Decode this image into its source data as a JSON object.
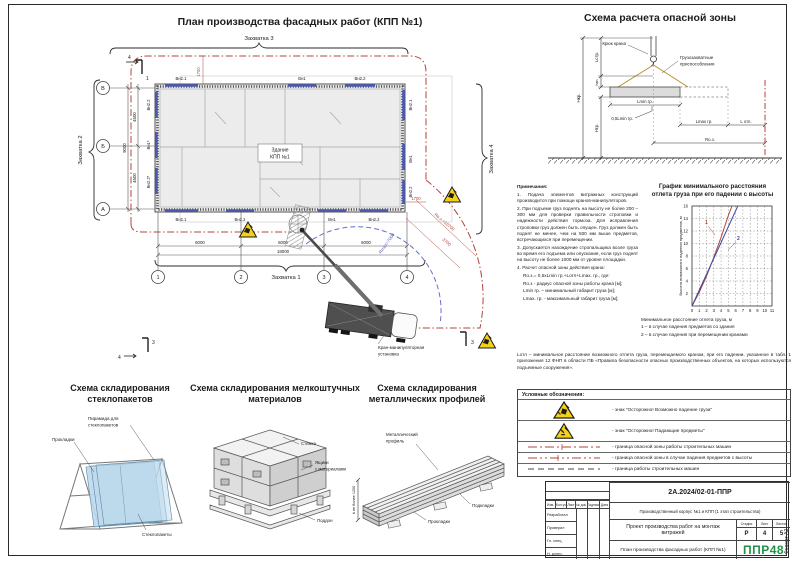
{
  "page": {
    "format_note": "Формат А2"
  },
  "plan": {
    "title": "План производства фасадных работ (КПП №1)",
    "building_line1": "Здание",
    "building_line2": "КПП №1",
    "zone1": "Захватка 1",
    "zone2": "Захватка 2",
    "zone3": "Захватка 3",
    "zone4": "Захватка 4",
    "axis_letters": [
      "В",
      "Б",
      "А"
    ],
    "axis_numbers": [
      "1",
      "2",
      "3",
      "4"
    ],
    "dim_4500a": "4500",
    "dim_4500b": "4500",
    "dim_9000": "9000",
    "dim_6000a": "6000",
    "dim_6000b": "6000",
    "dim_6000c": "6000",
    "dim_18000": "18000",
    "dim_1700_top": "1700",
    "dim_1700_right": "1700",
    "dim_3700": "3700",
    "r_danger": "Rо.з.=10700",
    "r_max": "Rmax=7000",
    "win_top": [
      "Вн2.1",
      "Вн1",
      "Вн2.2"
    ],
    "win_bottom": [
      "Вн2.1",
      "Вн2.2",
      "Вн1",
      "Вн2.2"
    ],
    "win_left": [
      "Вн2.2",
      "Вн1*",
      "Вн2.2*"
    ],
    "win_right": [
      "Вн2.1",
      "Вн1",
      "Вн2.2"
    ],
    "crane_line1": "Кран-манипуляторная",
    "crane_line2": "установка",
    "mark1": "1",
    "mark3": "3",
    "mark4": "4"
  },
  "danger_scheme": {
    "title": "Схема расчета опасной зоны",
    "hook": "Крюк крана",
    "rig1": "Грузозахватные",
    "rig2": "приспособления",
    "lmin": "Lmin гр.",
    "half_lmin": "0,5Lmin гр.",
    "lmax": "Lmax гр.",
    "lotl": "L отл.",
    "roz": "Rо.з.",
    "hkr": "Нкр.",
    "hgr": "Нгр.",
    "lstr": "Lстр.",
    "hzp": "hзп."
  },
  "graph": {
    "title1": "График минимального расстояния",
    "title2": "отлета груза при его падении с высоты",
    "ylabel": "Высота возможного падения предметов, м",
    "xlabel": "Минимальное расстояние отлета груза, м",
    "legend1": "1 – в случае падения предметов со здания",
    "legend2": "2 – в случае падения при перемещении кранами",
    "label1": "1",
    "label2": "2"
  },
  "chart_data": {
    "type": "line",
    "title": "График минимального расстояния отлета груза при его падении с высоты",
    "xlabel": "Минимальное расстояние отлета груза, м",
    "ylabel": "Высота возможного падения предметов, м",
    "xlim": [
      0,
      11
    ],
    "ylim": [
      0,
      16
    ],
    "grid": true,
    "x_ticks": [
      0,
      1,
      2,
      3,
      4,
      5,
      6,
      7,
      8,
      9,
      10,
      11
    ],
    "y_ticks": [
      2,
      4,
      6,
      8,
      10,
      12,
      14,
      16
    ],
    "series": [
      {
        "name": "1 – в случае падения предметов со здания",
        "color": "#b0443b",
        "x": [
          0,
          1,
          2,
          3,
          4,
          5,
          5.5
        ],
        "y": [
          0,
          2.2,
          4.8,
          7.8,
          11,
          14.5,
          16
        ]
      },
      {
        "name": "2 – в случае падения при перемещении кранами",
        "color": "#3a4aaa",
        "x": [
          0,
          6.3
        ],
        "y": [
          0,
          16
        ]
      }
    ]
  },
  "notes": {
    "heading": "Примечания:",
    "items": [
      "1. Подача элементов витражных конструкций производится при помощи кранов-манипуляторов.",
      "2. При подъеме груз поднять на высоту не более 200 – 300 мм для проверки правильности строповки и надежности действия тормоза. Для исправления строповки груз должен быть опущен. Груз должен быть поднят не менее, чем на 500 мм выше предметов, встречающихся при перемещении.",
      "3. Допускается нахождение стропальщика возле груза во время его подъема или опускания, если груз поднят на высоту не более 1000 мм от уровня площадки.",
      "4. Расчет опасной зоны действия крана:",
      "Rо.з.= 0,5xLmin гр.+Lотл+Lmax. гр., где:",
      "Rо.з - радиус опасной зоны работы крана [м];",
      "Lmin гр. – минимальный габарит груза [м];",
      "Lmax. гр. - максимальный габарит груза [м];"
    ]
  },
  "lotl_note": "Lотл – минимальное расстояние возможного отлета груза, перемещаемого краном, при его падении, указанное в табл. 1 приложения 12 ФНП в области ПБ «Правила безопасности опасных производственных объектов, на которых используются подъемные сооружения».",
  "legend": {
    "heading": "Условные обозначения:",
    "rows": [
      {
        "text": "- знак \"Осторожно! Возможно падение груза\""
      },
      {
        "text": "- знак \"Осторожно! Падающие предметы\""
      },
      {
        "text": "- граница опасной зоны работы строительных машин"
      },
      {
        "text": "- граница опасной зоны в случае падения предметов с высоты"
      },
      {
        "text": "- граница работы строительных машин"
      }
    ]
  },
  "storage": {
    "glass": {
      "title1": "Схема складирования",
      "title2": "стеклопакетов",
      "pyramid1": "Пирамида для",
      "pyramid2": "стеклопакетов",
      "spacers": "Прокладки",
      "panes": "Стеклопакеты"
    },
    "small": {
      "title1": "Схема складирования мелкоштучных",
      "title2": "материалов",
      "tie": "Стяжка",
      "boxes1": "Ящики",
      "boxes2": "с материалами",
      "pallet": "Поддон"
    },
    "metal": {
      "title1": "Схема складирования",
      "title2": "металлических профилей",
      "profile1": "Металлический",
      "profile2": "профиль",
      "supports": "Подкладки",
      "spacers": "Прокладки",
      "height": "h не более 1200"
    }
  },
  "titleblock": {
    "doc_number": "2А.2024/02-01-ППР",
    "object_name": "Производственный корпус №1 и КПП (1 этап строительства)",
    "project_name": "Проект производства работ на монтаж витражей",
    "sheet_name1": "План производства фасадных работ",
    "sheet_name2": "(КПП №1)",
    "stage_label": "Стадия",
    "sheet_label": "Лист",
    "sheets_label": "Листов",
    "stage": "Р",
    "sheet": "4",
    "sheets": "5",
    "logo": "ППР48",
    "cols": [
      "Изм.",
      "Кол.уч",
      "Лист",
      "№ док.",
      "Подпись",
      "Дата"
    ],
    "rows": [
      "Разработал",
      "Проверил",
      "Гл. спец.",
      "Н. контр."
    ]
  },
  "colors": {
    "danger": "#b0443b",
    "window": "#4a5ab5",
    "crane_arc": "#6a6ec6",
    "warning": "#f4d017",
    "logo": "#1f9246",
    "glass": "#bcd9ec"
  }
}
